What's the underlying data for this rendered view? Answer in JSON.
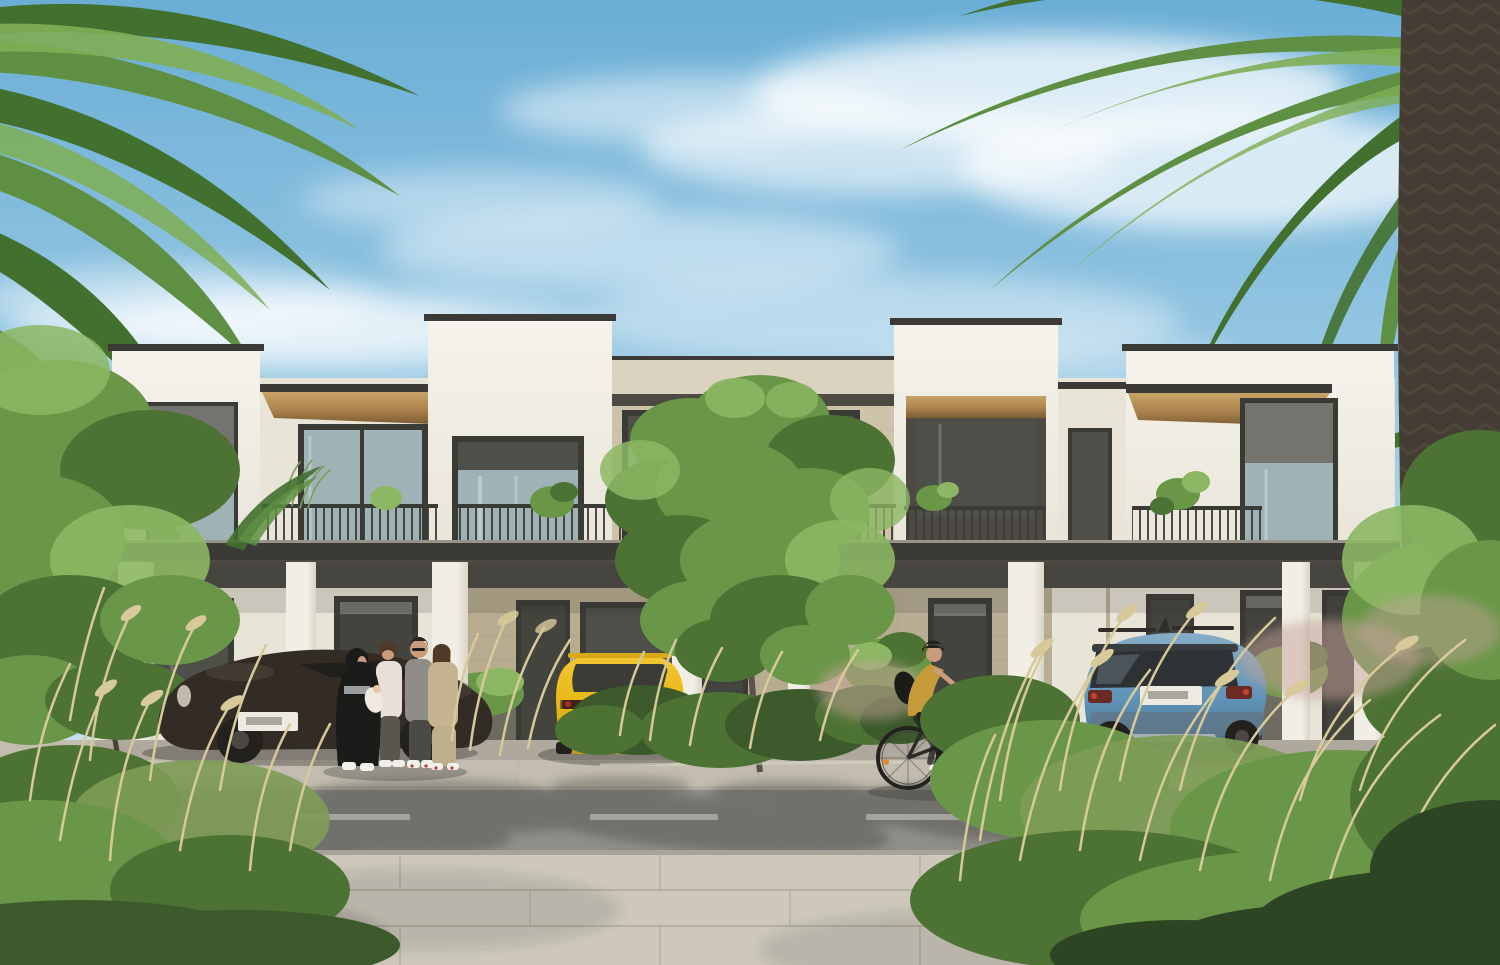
{
  "meta": {
    "width": 1500,
    "height": 965,
    "kind": "photorealistic exterior architectural rendering",
    "visible_text": "none (license plates present but not legible)"
  },
  "scene": {
    "description": "Street view of a modern two-storey flat-roof townhouse row in bright daylight, framed by date palms. White rendered parapet towers alternate with beige stone sections, dark-framed windows, timber soffits and balconies with thin metal railings. Under the ground-floor colonnade a dark sports car, a yellow hatchback and a blue compact SUV are parked. Four adults chat near the left entrance while a cyclist rides along the road. Ornamental dry grasses and shrubs fill the foreground beside a paved sidewalk and an asphalt road with a dashed centre line.",
    "sky": {
      "condition": "sunny, wispy cirrus clouds"
    },
    "building": {
      "storeys": 2,
      "style": "contemporary townhouse row",
      "facade_materials": [
        "white render",
        "beige stone",
        "dark window frames",
        "timber soffit"
      ],
      "features": [
        "roof parapets",
        "balconies with metal railings",
        "balcony plants",
        "covered colonnade",
        "dark glazed entrance doors",
        "planters"
      ]
    },
    "vehicles": [
      {
        "name": "dark sports car",
        "body_color": "#332c25",
        "position": "left carport, nose left",
        "license_plate": "white, characters not legible"
      },
      {
        "name": "yellow hatchback",
        "body_color": "#e9b816",
        "position": "centre driveway, rear view",
        "license_plate": "white, characters not legible"
      },
      {
        "name": "blue compact SUV",
        "body_color": "#5f94b8",
        "position": "right carport, rear three-quarter view",
        "license_plate": "white, characters not legible"
      }
    ],
    "people": [
      {
        "name": "woman in black hijab holding infant"
      },
      {
        "name": "man in light shirt"
      },
      {
        "name": "man in grey t-shirt and sunglasses"
      },
      {
        "name": "woman in beige suit"
      },
      {
        "name": "cyclist with black helmet, mustard top, black bicycle, riding right"
      }
    ],
    "vegetation": [
      "date palm left",
      "date palm right with thick trunk",
      "leafy tree left",
      "leafy centre tree in planting bed",
      "ornamental dry grasses",
      "dark green shrubs",
      "pink muhly grass",
      "balcony plants"
    ],
    "road": {
      "surface": "asphalt",
      "marking": "dashed white centre line"
    },
    "foreground": "large concrete pavers with soft palm shadows"
  },
  "palette": {
    "sky_top": "#6aaed6",
    "sky_mid": "#a9d2e8",
    "sky_low": "#ddeef5",
    "cloud": "#ffffff",
    "wall_white": "#f5f3ec",
    "wall_shade": "#e8e4d8",
    "coping": "#3b3a36",
    "stone_light": "#dbd3c0",
    "stone_mid": "#cdc3aa",
    "stone_dark": "#b8ac90",
    "wood_light": "#c9a366",
    "wood_mid": "#a87f4a",
    "wood_dark": "#7c5c33",
    "frame_dark": "#3b3b36",
    "glass_cool": "#9fb3b6",
    "glass_dark": "#4e4f48",
    "shade_gray": "#74736e",
    "railing_dark": "#3a3a37",
    "recess_dark": "#4c4a43",
    "pillar_light": "#f1eee5",
    "pillar_shade": "#d9d4c6",
    "door_dark": "#44443e",
    "planter_gray": "#6d6a60",
    "palm_green": "#5f8f42",
    "palm_dark": "#41702f",
    "palm_light": "#7fae54",
    "trunk_brown": "#453d33",
    "trunk_tex": "#5f564b",
    "leaf_green": "#6a9747",
    "leaf_dark": "#4d7334",
    "leaf_light": "#8cb763",
    "bush_dark": "#3c5a2c",
    "grass_dry": "#d8c99b",
    "grass_green": "#7e9c55",
    "muhly_pink": "#c5a29a",
    "car_dark": "#332c25",
    "car_yellow": "#e9b816",
    "car_yellow_dark": "#c79a0f",
    "car_blue": "#5f94b8",
    "car_blue_light": "#85adc8",
    "car_blue_dark": "#486f8d",
    "tyre": "#23211e",
    "plate_white": "#eceae2",
    "road_gray": "#8f8e89",
    "curb_light": "#b3aea2",
    "paver_light": "#cdc8bb",
    "paver_line": "#b2ad9f",
    "shadow_tint": "#2f2e2a",
    "skin": "#c99c7c",
    "cloth_black": "#1b1b1a",
    "cloth_gray": "#8e8d88",
    "cloth_beige": "#c6b491",
    "cloth_mustard": "#c49a3b",
    "shirt_light": "#e9dfd8",
    "hair_brown": "#4f3a28"
  }
}
